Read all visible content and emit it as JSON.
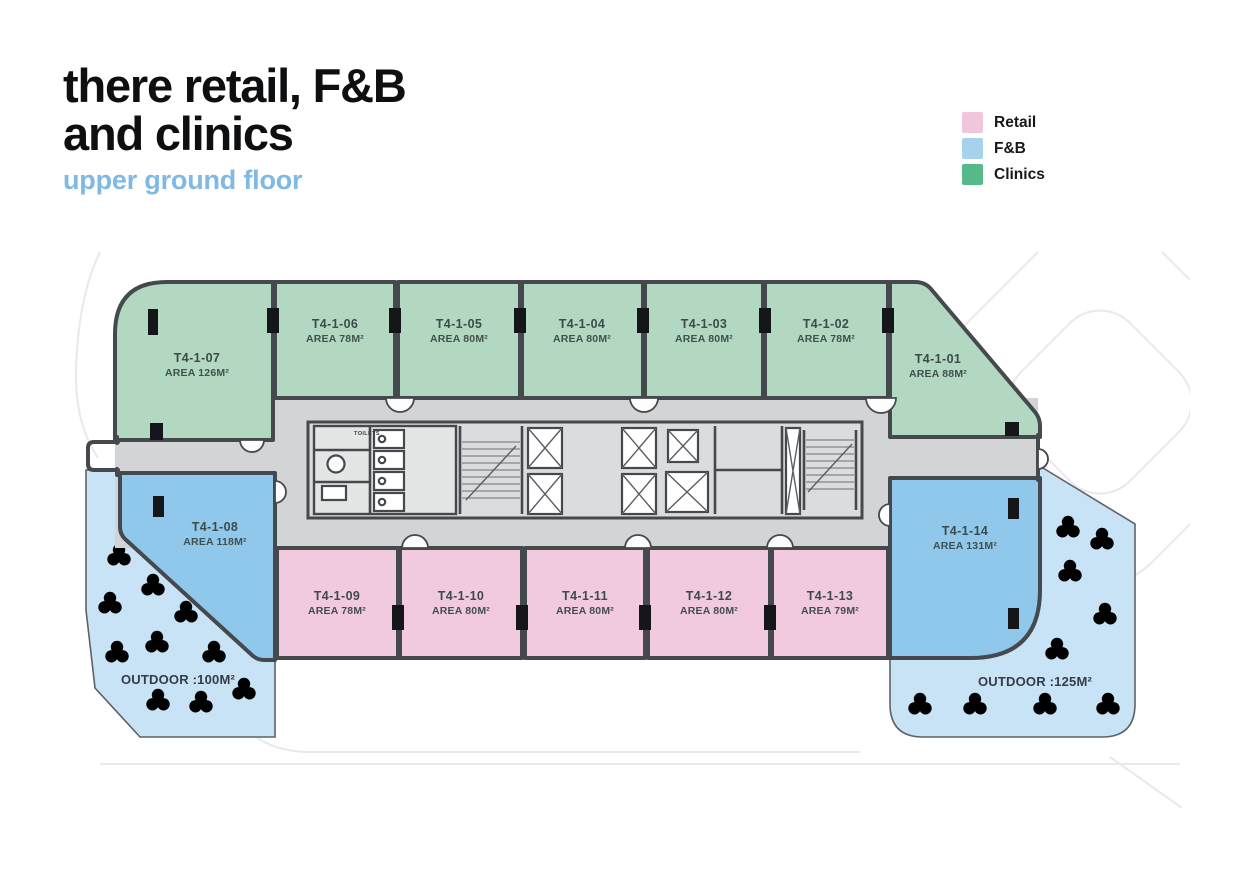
{
  "header": {
    "title_line1": "there retail, F&B",
    "title_line2": "and clinics",
    "subtitle": "upper ground floor"
  },
  "legend": [
    {
      "label": "Retail",
      "color": "#efc6dc"
    },
    {
      "label": "F&B",
      "color": "#a7d2ee"
    },
    {
      "label": "Clinics",
      "color": "#55b989"
    }
  ],
  "floorplan": {
    "zone_colors": {
      "clinics": "#b2d8c1",
      "retail": "#f1cadf",
      "fnb": "#8fc8ea",
      "outdoor": "#c8e3f5",
      "corridor": "#d3d4d5",
      "wall": "#45494e"
    },
    "units": [
      {
        "id": "T4-1-07",
        "area": "AREA 126M²",
        "zone": "clinics"
      },
      {
        "id": "T4-1-06",
        "area": "AREA 78M²",
        "zone": "clinics"
      },
      {
        "id": "T4-1-05",
        "area": "AREA 80M²",
        "zone": "clinics"
      },
      {
        "id": "T4-1-04",
        "area": "AREA 80M²",
        "zone": "clinics"
      },
      {
        "id": "T4-1-03",
        "area": "AREA 80M²",
        "zone": "clinics"
      },
      {
        "id": "T4-1-02",
        "area": "AREA 78M²",
        "zone": "clinics"
      },
      {
        "id": "T4-1-01",
        "area": "AREA 88M²",
        "zone": "clinics"
      },
      {
        "id": "T4-1-08",
        "area": "AREA 118M²",
        "zone": "fnb"
      },
      {
        "id": "T4-1-14",
        "area": "AREA 131M²",
        "zone": "fnb"
      },
      {
        "id": "T4-1-09",
        "area": "AREA 78M²",
        "zone": "retail"
      },
      {
        "id": "T4-1-10",
        "area": "AREA 80M²",
        "zone": "retail"
      },
      {
        "id": "T4-1-11",
        "area": "AREA 80M²",
        "zone": "retail"
      },
      {
        "id": "T4-1-12",
        "area": "AREA 80M²",
        "zone": "retail"
      },
      {
        "id": "T4-1-13",
        "area": "AREA 79M²",
        "zone": "retail"
      }
    ],
    "outdoor_areas": [
      {
        "label": "OUTDOOR :100M²"
      },
      {
        "label": "OUTDOOR :125M²"
      }
    ],
    "core": {
      "toilets_label": "TOILETS"
    }
  }
}
